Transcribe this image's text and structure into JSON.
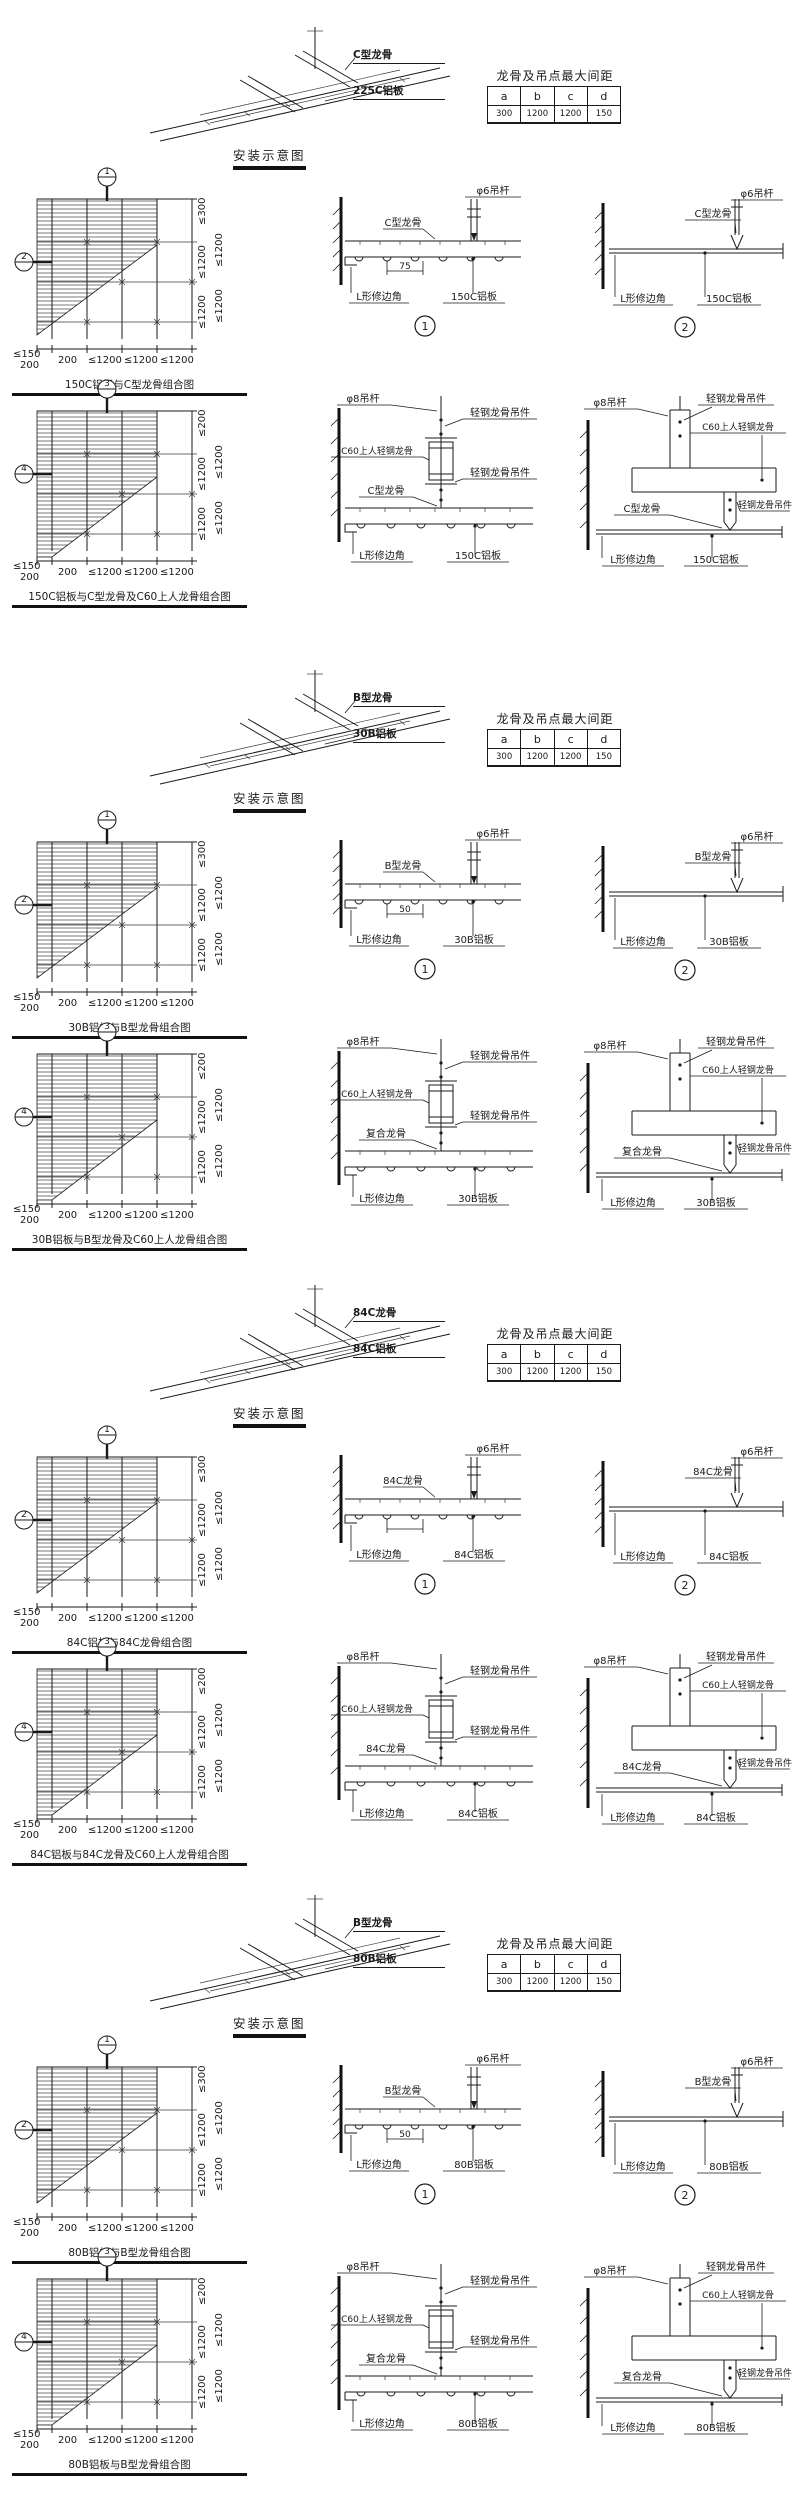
{
  "sheet": {
    "background": "#ffffff",
    "ink": "#1a1a1a"
  },
  "spec_table": {
    "title": "龙骨及吊点最大间距",
    "headers": [
      "a",
      "b",
      "c",
      "d"
    ]
  },
  "install_heading": "安装示意图",
  "sections": [
    {
      "iso": {
        "keel": "C型龙骨",
        "panel": "225C铝板"
      },
      "spacing_values": [
        "300",
        "1200",
        "1200",
        "150"
      ],
      "plan_a": {
        "callout_top": "1",
        "callout_left": "2",
        "dims_right": [
          "≤300",
          "≤1200",
          "≤1200"
        ],
        "dims_right_outer": [
          "≤1200",
          "≤1200"
        ],
        "dims_left": [
          "≤150",
          "200"
        ],
        "dims_bottom": [
          "200",
          "≤1200",
          "≤1200",
          "≤1200"
        ],
        "caption": "150C铝板与C型龙骨组合图"
      },
      "plan_b": {
        "callout_top": "3",
        "callout_left": "4",
        "dims_right": [
          "≤200",
          "≤1200",
          "≤1200"
        ],
        "dims_right_outer": [
          "≤1200",
          "≤1200"
        ],
        "dims_left": [
          "≤150",
          "200"
        ],
        "dims_bottom": [
          "200",
          "≤1200",
          "≤1200",
          "≤1200"
        ],
        "caption": "150C铝板与C型龙骨及C60上人龙骨组合图"
      },
      "d1": {
        "num": "1",
        "keel": "C型龙骨",
        "rod": "φ6吊杆",
        "dim": "75",
        "edge": "L形修边角",
        "panel": "150C铝板"
      },
      "d2": {
        "num": "2",
        "rod": "φ6吊杆",
        "keel": "C型龙骨",
        "edge": "L形修边角",
        "panel": "150C铝板"
      },
      "d3": {
        "rod": "φ8吊杆",
        "hanger1": "轻钢龙骨吊件",
        "c60": "C60上人轻钢龙骨",
        "hanger2": "轻钢龙骨吊件",
        "keel": "C型龙骨",
        "edge": "L形修边角",
        "panel": "150C铝板"
      },
      "d4": {
        "rod": "φ8吊杆",
        "hanger1": "轻钢龙骨吊件",
        "c60": "C60上人轻钢龙骨",
        "hanger2": "轻钢龙骨吊件",
        "keel": "C型龙骨",
        "edge": "L形修边角",
        "panel": "150C铝板"
      }
    },
    {
      "iso": {
        "keel": "B型龙骨",
        "panel": "30B铝板"
      },
      "spacing_values": [
        "300",
        "1200",
        "1200",
        "150"
      ],
      "plan_a": {
        "callout_top": "1",
        "callout_left": "2",
        "dims_right": [
          "≤300",
          "≤1200",
          "≤1200"
        ],
        "dims_right_outer": [
          "≤1200",
          "≤1200"
        ],
        "dims_left": [
          "≤150",
          "200"
        ],
        "dims_bottom": [
          "200",
          "≤1200",
          "≤1200",
          "≤1200"
        ],
        "caption": "30B铝板与B型龙骨组合图"
      },
      "plan_b": {
        "callout_top": "3",
        "callout_left": "4",
        "dims_right": [
          "≤200",
          "≤1200",
          "≤1200"
        ],
        "dims_right_outer": [
          "≤1200",
          "≤1200"
        ],
        "dims_left": [
          "≤150",
          "200"
        ],
        "dims_bottom": [
          "200",
          "≤1200",
          "≤1200",
          "≤1200"
        ],
        "caption": "30B铝板与B型龙骨及C60上人龙骨组合图"
      },
      "d1": {
        "num": "1",
        "keel": "B型龙骨",
        "rod": "φ6吊杆",
        "dim": "50",
        "edge": "L形修边角",
        "panel": "30B铝板"
      },
      "d2": {
        "num": "2",
        "rod": "φ6吊杆",
        "keel": "B型龙骨",
        "edge": "L形修边角",
        "panel": "30B铝板"
      },
      "d3": {
        "rod": "φ8吊杆",
        "hanger1": "轻钢龙骨吊件",
        "c60": "C60上人轻钢龙骨",
        "hanger2": "轻钢龙骨吊件",
        "keel": "复合龙骨",
        "edge": "L形修边角",
        "panel": "30B铝板"
      },
      "d4": {
        "rod": "φ8吊杆",
        "hanger1": "轻钢龙骨吊件",
        "c60": "C60上人轻钢龙骨",
        "hanger2": "轻钢龙骨吊件",
        "keel": "复合龙骨",
        "edge": "L形修边角",
        "panel": "30B铝板"
      }
    },
    {
      "iso": {
        "keel": "84C龙骨",
        "panel": "84C铝板"
      },
      "spacing_values": [
        "300",
        "1200",
        "1200",
        "150"
      ],
      "plan_a": {
        "callout_top": "1",
        "callout_left": "2",
        "dims_right": [
          "≤300",
          "≤1200",
          "≤1200"
        ],
        "dims_right_outer": [
          "≤1200",
          "≤1200"
        ],
        "dims_left": [
          "≤150",
          "200"
        ],
        "dims_bottom": [
          "200",
          "≤1200",
          "≤1200",
          "≤1200"
        ],
        "caption": "84C铝板与84C龙骨组合图"
      },
      "plan_b": {
        "callout_top": "3",
        "callout_left": "4",
        "dims_right": [
          "≤200",
          "≤1200",
          "≤1200"
        ],
        "dims_right_outer": [
          "≤1200",
          "≤1200"
        ],
        "dims_left": [
          "≤150",
          "200"
        ],
        "dims_bottom": [
          "200",
          "≤1200",
          "≤1200",
          "≤1200"
        ],
        "caption": "84C铝板与84C龙骨及C60上人龙骨组合图"
      },
      "d1": {
        "num": "1",
        "keel": "84C龙骨",
        "rod": "φ6吊杆",
        "dim": "",
        "edge": "L形修边角",
        "panel": "84C铝板"
      },
      "d2": {
        "num": "2",
        "rod": "φ6吊杆",
        "keel": "84C龙骨",
        "edge": "L形修边角",
        "panel": "84C铝板"
      },
      "d3": {
        "rod": "φ8吊杆",
        "hanger1": "轻钢龙骨吊件",
        "c60": "C60上人轻钢龙骨",
        "hanger2": "轻钢龙骨吊件",
        "keel": "84C龙骨",
        "edge": "L形修边角",
        "panel": "84C铝板"
      },
      "d4": {
        "rod": "φ8吊杆",
        "hanger1": "轻钢龙骨吊件",
        "c60": "C60上人轻钢龙骨",
        "hanger2": "轻钢龙骨吊件",
        "keel": "84C龙骨",
        "edge": "L形修边角",
        "panel": "84C铝板"
      }
    },
    {
      "iso": {
        "keel": "B型龙骨",
        "panel": "80B铝板"
      },
      "spacing_values": [
        "300",
        "1200",
        "1200",
        "150"
      ],
      "plan_a": {
        "callout_top": "1",
        "callout_left": "2",
        "dims_right": [
          "≤300",
          "≤1200",
          "≤1200"
        ],
        "dims_right_outer": [
          "≤1200",
          "≤1200"
        ],
        "dims_left": [
          "≤150",
          "200"
        ],
        "dims_bottom": [
          "200",
          "≤1200",
          "≤1200",
          "≤1200"
        ],
        "caption": "80B铝板与B型龙骨组合图"
      },
      "plan_b": {
        "callout_top": "3",
        "callout_left": "4",
        "dims_right": [
          "≤200",
          "≤1200",
          "≤1200"
        ],
        "dims_right_outer": [
          "≤1200",
          "≤1200"
        ],
        "dims_left": [
          "≤150",
          "200"
        ],
        "dims_bottom": [
          "200",
          "≤1200",
          "≤1200",
          "≤1200"
        ],
        "caption": "80B铝板与B型龙骨组合图"
      },
      "d1": {
        "num": "1",
        "keel": "B型龙骨",
        "rod": "φ6吊杆",
        "dim": "50",
        "edge": "L形修边角",
        "panel": "80B铝板"
      },
      "d2": {
        "num": "2",
        "rod": "φ6吊杆",
        "keel": "B型龙骨",
        "edge": "L形修边角",
        "panel": "80B铝板"
      },
      "d3": {
        "rod": "φ8吊杆",
        "hanger1": "轻钢龙骨吊件",
        "c60": "C60上人轻钢龙骨",
        "hanger2": "轻钢龙骨吊件",
        "keel": "复合龙骨",
        "edge": "L形修边角",
        "panel": "80B铝板"
      },
      "d4": {
        "rod": "φ8吊杆",
        "hanger1": "轻钢龙骨吊件",
        "c60": "C60上人轻钢龙骨",
        "hanger2": "轻钢龙骨吊件",
        "keel": "复合龙骨",
        "edge": "L形修边角",
        "panel": "80B铝板"
      }
    }
  ]
}
